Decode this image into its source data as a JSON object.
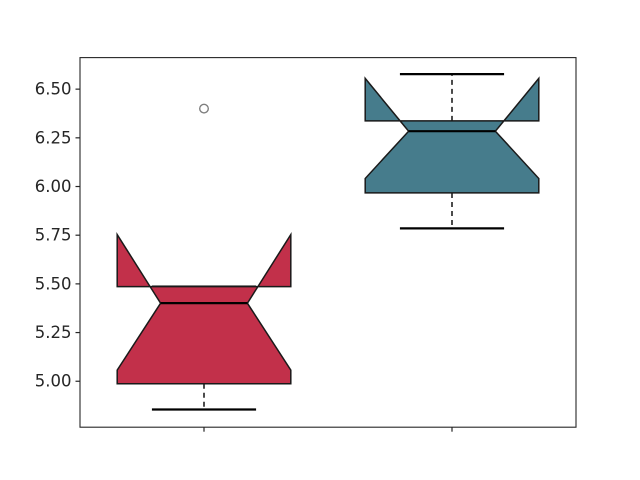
{
  "figure": {
    "background": "#ffffff",
    "title": "",
    "xlabel": "",
    "ylabel": ""
  },
  "chart_data": {
    "type": "boxplot",
    "variant": "notched-vertical",
    "title": "",
    "xlabel": "",
    "ylabel": "",
    "grid": false,
    "legend": null,
    "xlim": [
      0.5,
      2.5
    ],
    "ylim": [
      4.764,
      6.662
    ],
    "yticks": [
      "5.00",
      "5.25",
      "5.50",
      "5.75",
      "6.00",
      "6.25",
      "6.50"
    ],
    "ytick_values": [
      5.0,
      5.25,
      5.5,
      5.75,
      6.0,
      6.25,
      6.5
    ],
    "xtick_positions": [
      1,
      2
    ],
    "xtick_labels": [
      "",
      ""
    ],
    "box_width": 0.7,
    "notch_width": 0.35,
    "cap_width": 0.42,
    "boxes": [
      {
        "name": "group-1",
        "position": 1,
        "fill_color": "#c2304a",
        "whisker_low": 4.855,
        "q1": 4.987,
        "median": 5.401,
        "q3": 5.486,
        "whisker_high": 5.486,
        "notch_low": 5.057,
        "notch_high": 5.753,
        "fliers": [
          6.4
        ]
      },
      {
        "name": "group-2",
        "position": 2,
        "fill_color": "#467c8c",
        "whisker_low": 5.785,
        "q1": 5.967,
        "median": 6.284,
        "q3": 6.337,
        "whisker_high": 6.577,
        "notch_low": 6.041,
        "notch_high": 6.555,
        "fliers": []
      }
    ],
    "style": {
      "box_edge_color": "#1a1a1a",
      "box_edge_width": 1.5,
      "median_color": "#000000",
      "median_width": 2.2,
      "cap_color": "#000000",
      "cap_width_px": 2.2,
      "whisker_color": "#000000",
      "whisker_dash": "5 4",
      "whisker_width": 1.4,
      "flier_edge_color": "#7f7f7f",
      "flier_fill": "none",
      "flier_radius": 4.3,
      "spine_color": "#262626",
      "tick_label_color": "#262626"
    }
  }
}
